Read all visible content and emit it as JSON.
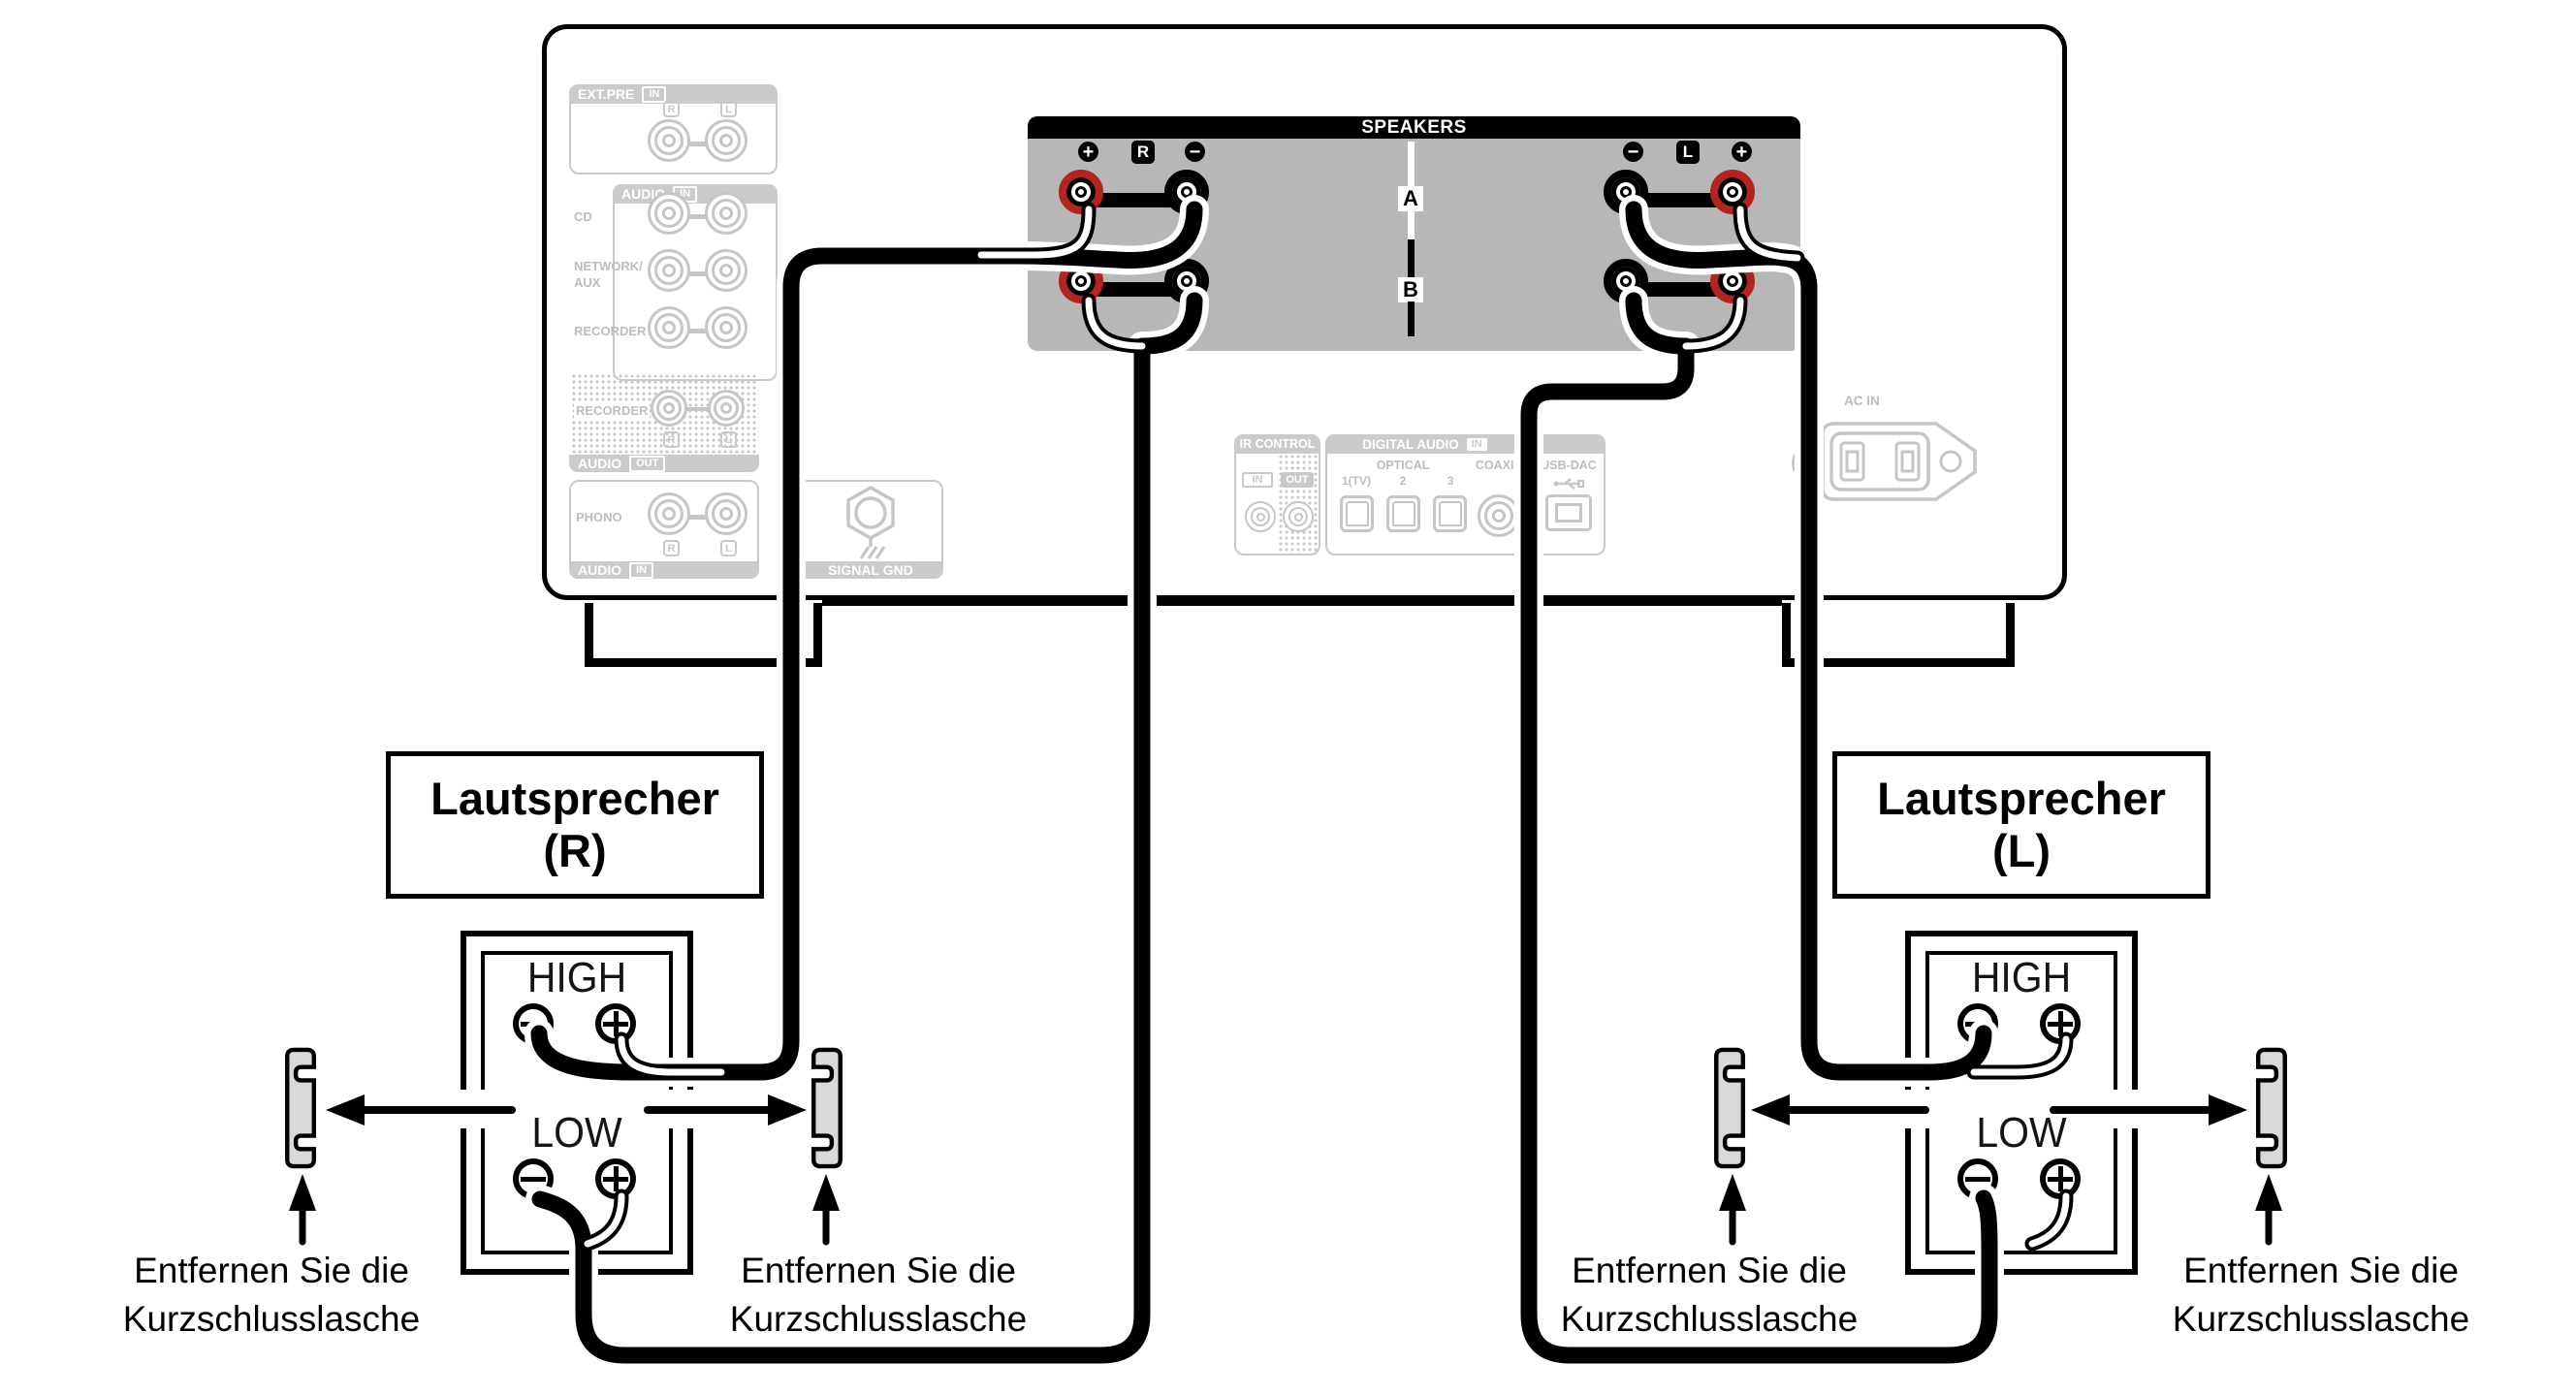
{
  "rear_panel": {
    "ext_pre": {
      "title": "EXT.PRE",
      "badge": "IN",
      "r": "R",
      "l": "L"
    },
    "audio_in_top": {
      "title": "AUDIO",
      "badge": "IN",
      "row_cd": "CD",
      "row_network_1": "NETWORK/",
      "row_network_2": "AUX",
      "row_recorder": "RECORDER"
    },
    "recorder_out": {
      "row": "RECORDER",
      "title": "AUDIO",
      "badge": "OUT",
      "r": "R",
      "l": "L"
    },
    "phono": {
      "row": "PHONO",
      "title": "AUDIO",
      "badge": "IN",
      "r": "R",
      "l": "L"
    },
    "signal_gnd": {
      "title": "SIGNAL GND"
    },
    "speakers": {
      "title": "SPEAKERS",
      "r_plus": "+",
      "r_label": "R",
      "r_minus": "−",
      "l_minus": "−",
      "l_label": "L",
      "l_plus": "+",
      "group_a": "A",
      "group_b": "B"
    },
    "ir_control": {
      "title": "IR CONTROL",
      "in_badge": "IN",
      "out_badge": "OUT"
    },
    "digital_audio": {
      "title": "DIGITAL AUDIO",
      "badge": "IN",
      "optical": "OPTICAL",
      "opt1": "1(TV)",
      "opt2": "2",
      "opt3": "3",
      "coaxial": "COAXIAL",
      "usb_dac": "USB-DAC"
    },
    "ac_in": {
      "label": "AC IN"
    }
  },
  "speaker_r": {
    "title": "Lautsprecher",
    "channel": "(R)",
    "high": "HIGH",
    "low": "LOW"
  },
  "speaker_l": {
    "title": "Lautsprecher",
    "channel": "(L)",
    "high": "HIGH",
    "low": "LOW"
  },
  "instruction": {
    "line1": "Entfernen Sie die",
    "line2": "Kurzschlusslasche"
  },
  "colors": {
    "positive_terminal_ring": "#b5231d",
    "panel_gray": "#b7b7b7",
    "outline_gray": "#c6c6c6",
    "tab_gray": "#d9d9d9",
    "cable": "#000000"
  }
}
